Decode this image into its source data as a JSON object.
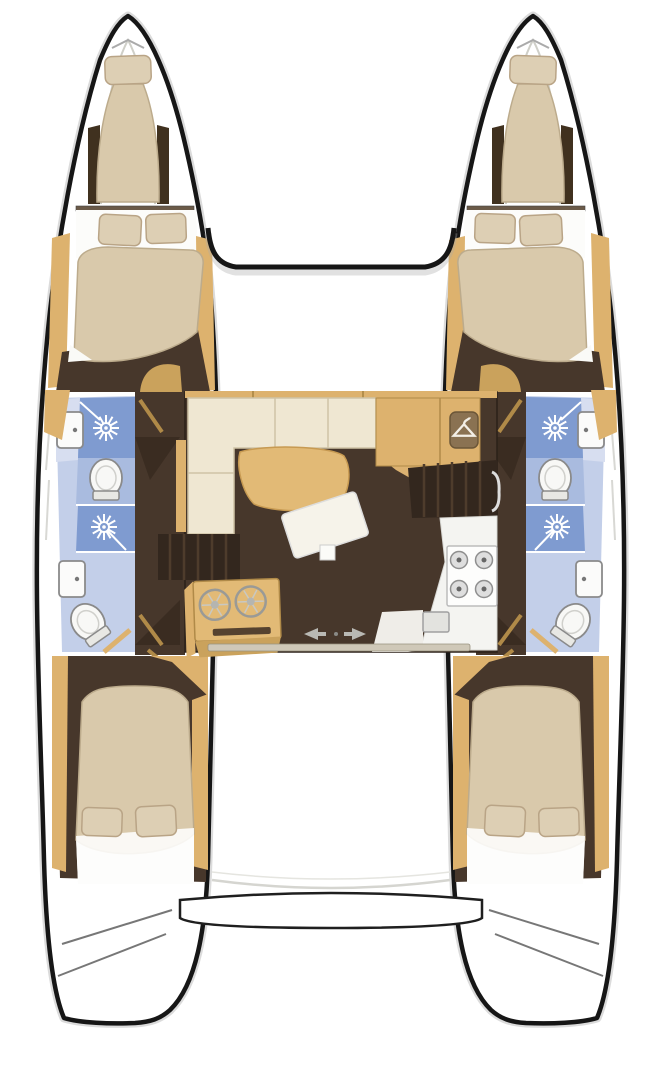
{
  "diagram": {
    "kind": "boat-interior-floor-plan",
    "vessel": "sailing catamaran, top-down layout",
    "hulls": [
      {
        "side": "port",
        "rooms": [
          {
            "name": "forepeak-berth",
            "features": [
              "single-berth",
              "pillow",
              "bow-hatch"
            ]
          },
          {
            "name": "forward-cabin",
            "features": [
              "double-berth",
              "pillow",
              "pillow",
              "wood-shelves"
            ]
          },
          {
            "name": "forward-bathroom",
            "features": [
              "sink",
              "shower-stall",
              "toilet"
            ]
          },
          {
            "name": "aft-bathroom",
            "features": [
              "shower-stall",
              "sink",
              "toilet"
            ]
          },
          {
            "name": "hull-corridor",
            "features": [
              "cabin-doors"
            ]
          },
          {
            "name": "aft-cabin",
            "features": [
              "double-berth",
              "pillow",
              "pillow"
            ]
          }
        ]
      },
      {
        "side": "starboard",
        "rooms": [
          {
            "name": "forepeak-berth",
            "features": [
              "single-berth",
              "pillow",
              "bow-hatch"
            ]
          },
          {
            "name": "forward-cabin",
            "features": [
              "double-berth",
              "pillow",
              "pillow",
              "wood-shelves"
            ]
          },
          {
            "name": "forward-bathroom",
            "features": [
              "sink",
              "shower-stall",
              "toilet"
            ]
          },
          {
            "name": "aft-bathroom",
            "features": [
              "shower-stall",
              "sink",
              "toilet"
            ]
          },
          {
            "name": "hull-corridor",
            "features": [
              "cabin-doors"
            ]
          },
          {
            "name": "aft-cabin",
            "features": [
              "double-berth",
              "pillow",
              "pillow"
            ]
          }
        ]
      }
    ],
    "saloon": {
      "features": [
        "l-shaped-sofa",
        "saloon-table",
        "coffee-table-pad",
        "nav-cabinets",
        "wardrobe-with-hanger-icon",
        "steps-to-port-hull",
        "steps-to-starboard-hull",
        "galley-unit-twin-round-basins",
        "galley-counter",
        "stove-4-burners",
        "galley-sink",
        "sliding-door-with-arrows",
        "door-track"
      ]
    },
    "exterior": [
      "bow-trampoline-gap",
      "forward-crossbeam",
      "cockpit-area",
      "stern-platform",
      "transom-steps-port",
      "transom-steps-starboard"
    ]
  },
  "icons": {
    "shower": "starburst-showerhead-icon",
    "wardrobe": "clothes-hanger-icon",
    "sliding_door": "left-right-arrows-icon",
    "stove": "four-burner-cooktop-icon",
    "galley_basins": "twin-round-basin-icon",
    "toilet": "toilet-top-view-icon",
    "sink": "rectangular-basin-icon"
  },
  "palette": {
    "hull-outline": "#161616",
    "hull-shadow": "#b0b0b0",
    "wood": "#ddb26e",
    "wood-dark": "#b08a48",
    "wood-deep": "#caa25c",
    "floor-dark": "#47372b",
    "floor-darker": "#33271e",
    "cushion-cream": "#efe7d2",
    "mattress": "#d9c9ab",
    "pillow": "#ddcfb4",
    "shower-blue": "#7f9bd0",
    "bath-blue": "#c3cfe9",
    "bath-blue-mid": "#a9bbdf",
    "bath-counter": "#d7def0",
    "counter-white": "#f4f4f1",
    "steel-gray": "#dedede",
    "track": "#cfc8b8",
    "arrow-gray": "#b9b9b4"
  }
}
